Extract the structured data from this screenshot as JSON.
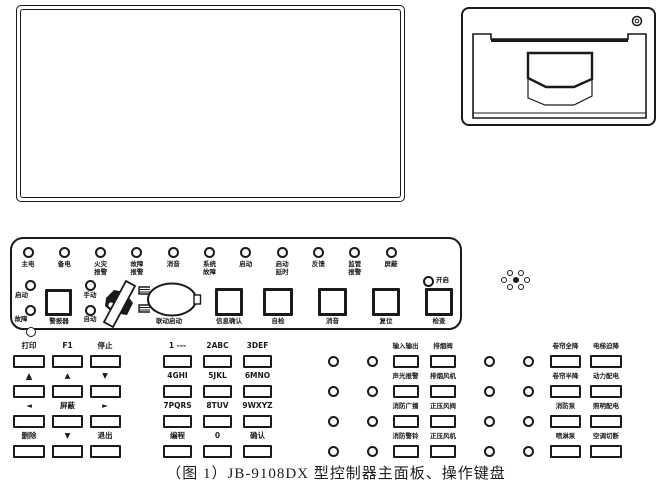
{
  "caption": "（图 1）JB-9108DX 型控制器主面板、操作键盘",
  "indicator_leds": [
    {
      "label": "主电"
    },
    {
      "label": "备电"
    },
    {
      "label": "火灾\n报警"
    },
    {
      "label": "故障\n报警"
    },
    {
      "label": "消音"
    },
    {
      "label": "系统\n故障"
    },
    {
      "label": "启动"
    },
    {
      "label": "启动\n延时"
    },
    {
      "label": "反馈"
    },
    {
      "label": "监管\n报警"
    },
    {
      "label": "屏蔽"
    }
  ],
  "control_area": {
    "start_led": "启动",
    "fault_led": "故障",
    "manual_led": "手动",
    "auto_led": "自动",
    "open_led": "开启",
    "sounder_button": "警报器",
    "linkage_start_button": "联动启动",
    "info_confirm_button": "信息确认",
    "self_test_button": "自检",
    "mute_button": "消音",
    "reset_button": "复位",
    "check_button": "检查"
  },
  "keypad_left": [
    {
      "label": "打印"
    },
    {
      "label": "F1"
    },
    {
      "label": "停止"
    },
    {
      "label": "▲"
    },
    {
      "label": "▲"
    },
    {
      "label": "▼"
    },
    {
      "label": "◄"
    },
    {
      "label": "屏蔽"
    },
    {
      "label": "►"
    },
    {
      "label": "删除"
    },
    {
      "label": "▼"
    },
    {
      "label": "退出"
    }
  ],
  "keypad_num": [
    {
      "label": "1 ---"
    },
    {
      "label": "2ABC"
    },
    {
      "label": "3DEF"
    },
    {
      "label": "4GHI"
    },
    {
      "label": "5JKL"
    },
    {
      "label": "6MNO"
    },
    {
      "label": "7PQRS"
    },
    {
      "label": "8TUV"
    },
    {
      "label": "9WXYZ"
    },
    {
      "label": "编程"
    },
    {
      "label": "0"
    },
    {
      "label": "确认"
    }
  ],
  "device_keys_mid": [
    {
      "label": "输入输出"
    },
    {
      "label": "排烟阀"
    },
    {
      "label": "声光报警"
    },
    {
      "label": "排烟风机"
    },
    {
      "label": "消防广播"
    },
    {
      "label": "正压风阀"
    },
    {
      "label": "消防警铃"
    },
    {
      "label": "正压风机"
    }
  ],
  "device_keys_right": [
    {
      "label": "卷帘全降"
    },
    {
      "label": "电梯迫降"
    },
    {
      "label": "卷帘半降"
    },
    {
      "label": "动力配电"
    },
    {
      "label": "消防泵"
    },
    {
      "label": "照明配电"
    },
    {
      "label": "喷淋泵"
    },
    {
      "label": "空调切断"
    }
  ]
}
